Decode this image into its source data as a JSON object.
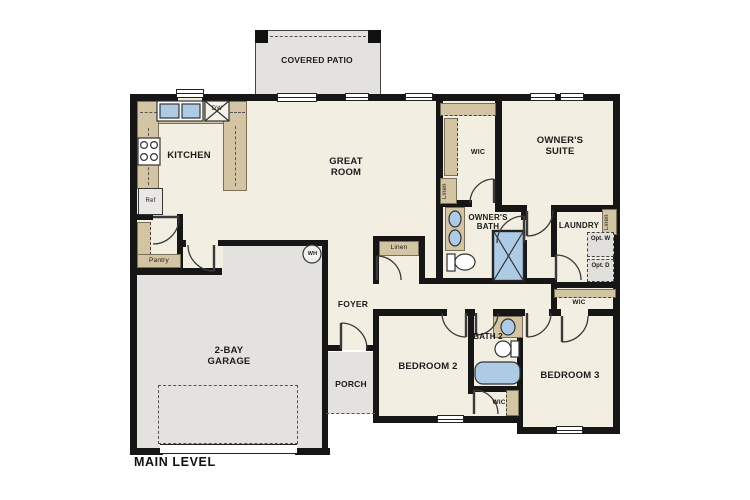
{
  "plan": {
    "title": "MAIN LEVEL",
    "rooms": {
      "covered_patio": "COVERED PATIO",
      "kitchen": "KITCHEN",
      "great_room": "GREAT ROOM",
      "owners_wic": "WIC",
      "owners_suite": "OWNER'S SUITE",
      "owners_bath": "OWNER'S BATH",
      "laundry": "LAUNDRY",
      "foyer": "FOYER",
      "porch": "PORCH",
      "garage": "2-BAY GARAGE",
      "bedroom2": "BEDROOM 2",
      "bath2": "BATH 2",
      "bedroom3": "BEDROOM 3",
      "bedroom3_wic": "WIC",
      "bedroom2_wic": "WIC"
    },
    "fixtures": {
      "refrigerator": "Ref",
      "dishwasher": "DW",
      "pantry": "Pantry",
      "linen_owners": "Linen",
      "linen_laundry": "Linen",
      "linen_hall": "Linen",
      "water_heater": "WH",
      "optional_washer": "Opt. W",
      "optional_dryer": "Opt. D"
    },
    "colors": {
      "wall": "#161616",
      "floor": "#f3eee2",
      "concrete": "#e3e2de",
      "cabinetry": "#d3c5a4",
      "fixture_blue": "#aecbe6"
    }
  }
}
